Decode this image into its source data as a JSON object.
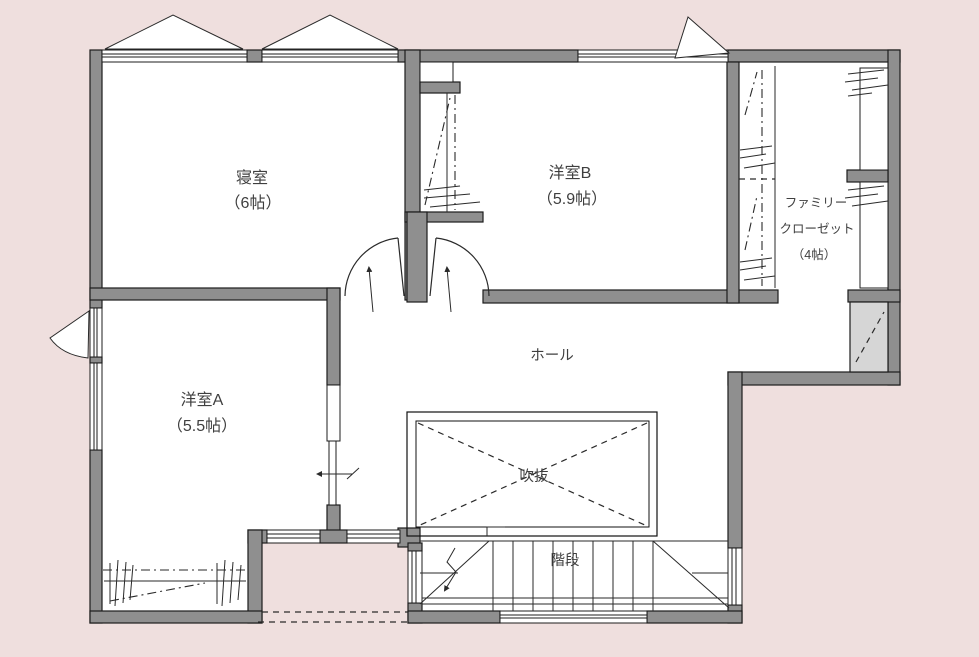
{
  "plan": {
    "colors": {
      "background": "#efdfde",
      "wall": "#8f8f8f",
      "outline": "#1c1c1c",
      "shaded": "#d6d6d6",
      "interior": "#ffffff",
      "text": "#3f3f3f"
    },
    "rooms": {
      "bedroom": {
        "name": "寝室",
        "size": "（6帖）"
      },
      "western_room_b": {
        "name": "洋室B",
        "size": "（5.9帖）"
      },
      "western_room_a": {
        "name": "洋室A",
        "size": "（5.5帖）"
      },
      "family_closet": {
        "name_line1": "ファミリー",
        "name_line2": "クローゼット",
        "size": "（4帖）"
      },
      "hall": {
        "name": "ホール"
      },
      "atrium": {
        "name": "吹抜"
      },
      "stairs": {
        "name": "階段"
      }
    }
  }
}
